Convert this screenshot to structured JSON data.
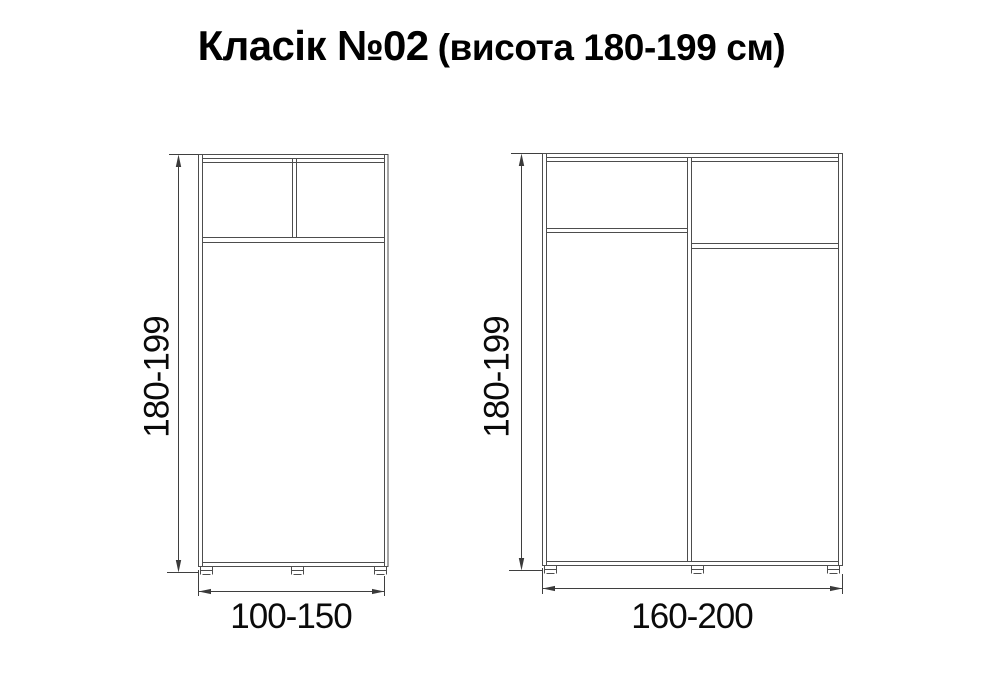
{
  "title": {
    "main": "Класік №02",
    "sub": "(висота 180-199 см)"
  },
  "diagrams": {
    "left_wardrobe": {
      "height_label": "180-199",
      "width_label": "100-150"
    },
    "right_wardrobe": {
      "height_label": "180-199",
      "width_label": "160-200"
    }
  },
  "colors": {
    "line": "#4d4d4d",
    "arrow": "#3a3a3a",
    "label_text": "#0a0a0a",
    "title_text": "#000000",
    "background": "#ffffff"
  }
}
